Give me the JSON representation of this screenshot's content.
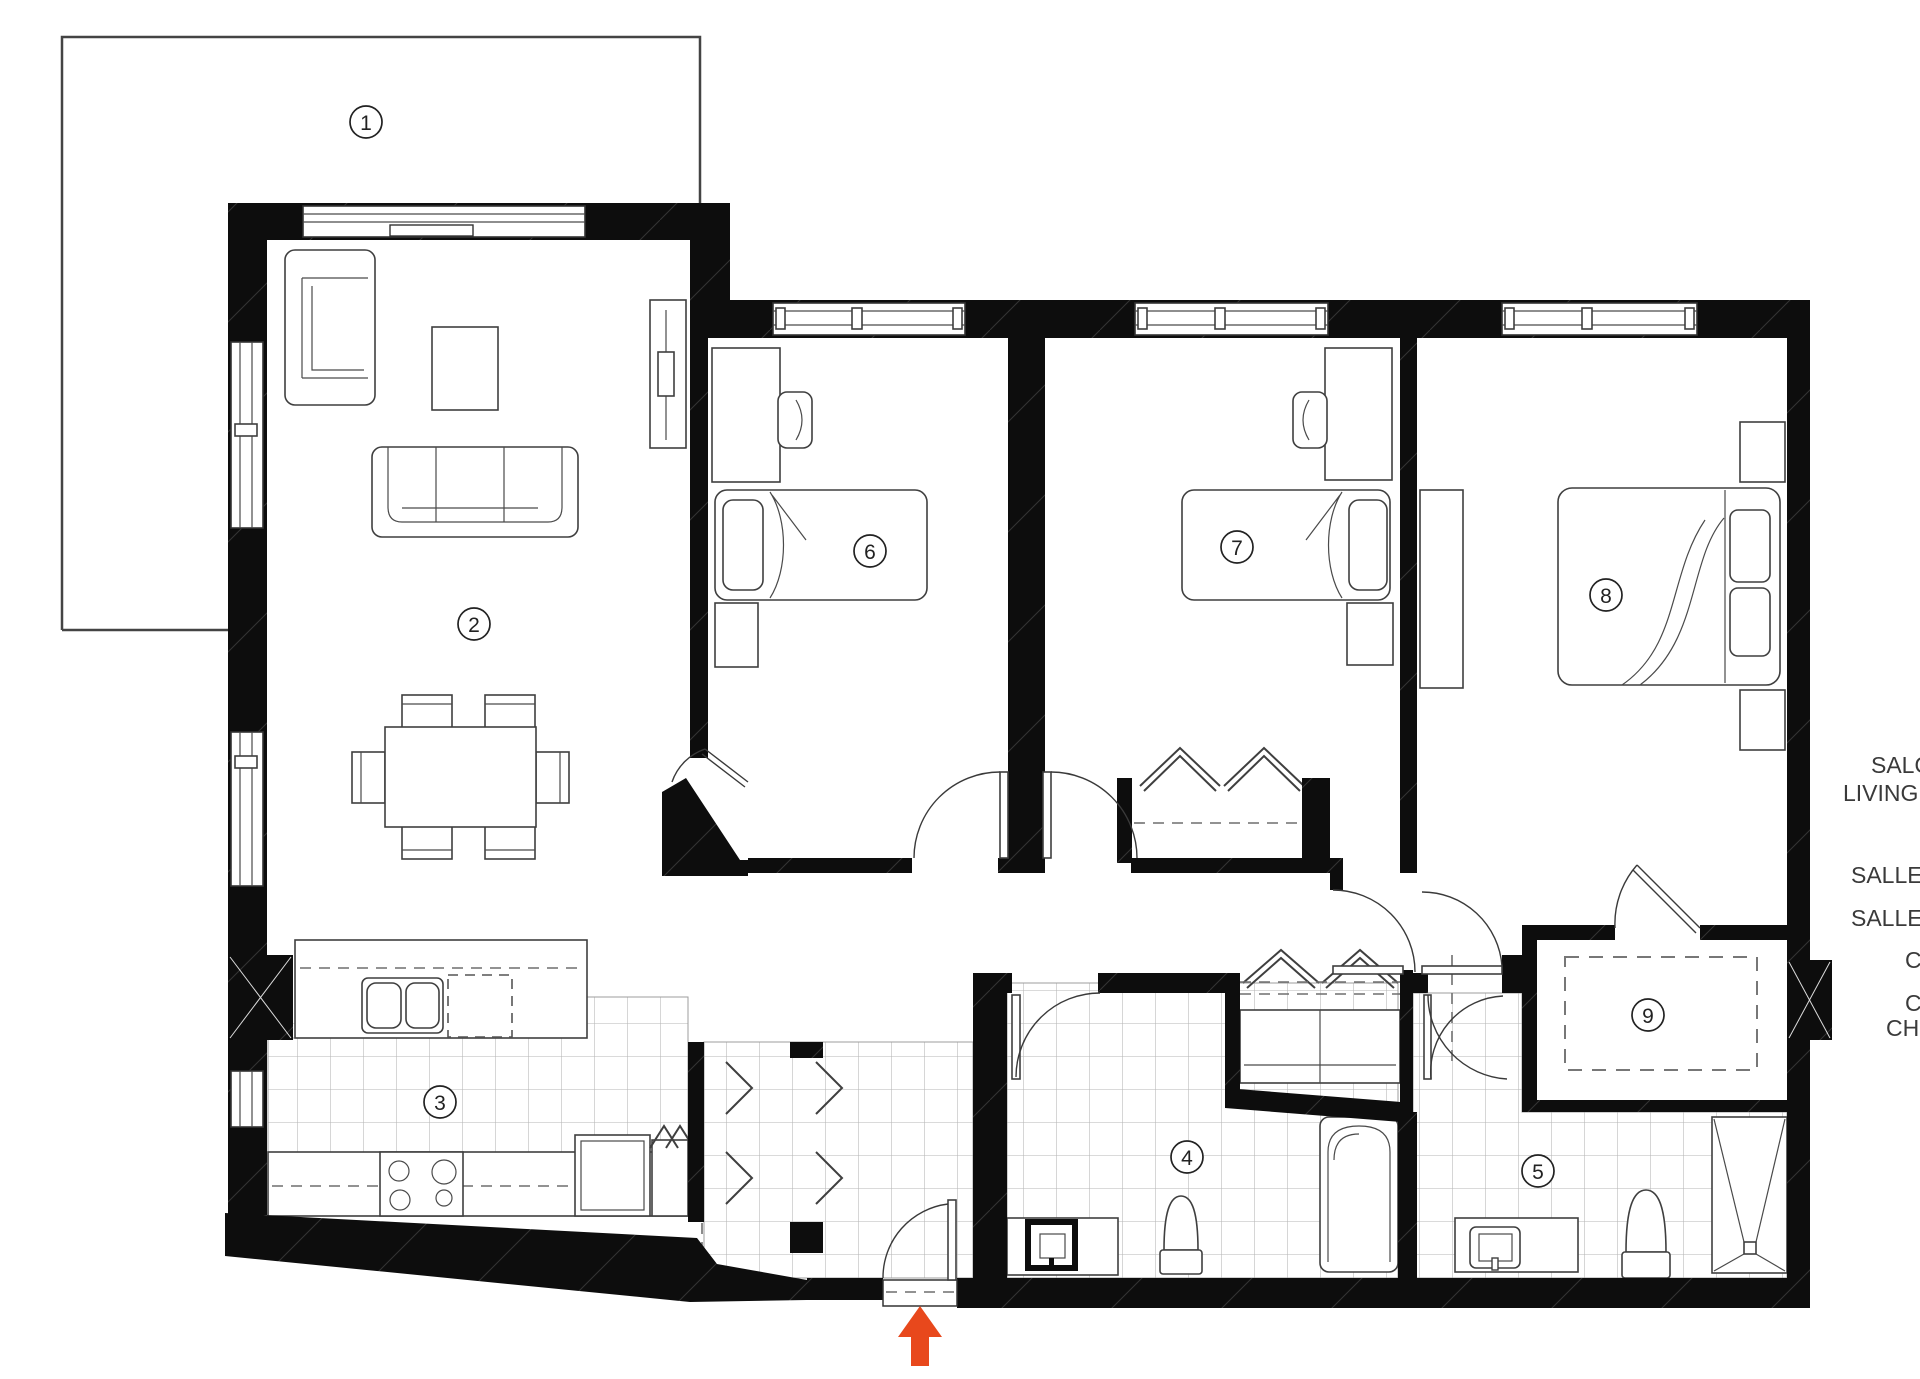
{
  "plan": {
    "rooms": [
      {
        "number": "1"
      },
      {
        "number": "2"
      },
      {
        "number": "3"
      },
      {
        "number": "4"
      },
      {
        "number": "5"
      },
      {
        "number": "6"
      },
      {
        "number": "7"
      },
      {
        "number": "8"
      },
      {
        "number": "9"
      }
    ],
    "legend": {
      "items": [
        "SALO",
        "LIVING R",
        "SALLE",
        "SALLE",
        "C",
        "C",
        "CH"
      ]
    },
    "entrance": {
      "arrow_color": "#e8481c"
    },
    "colors": {
      "wall_ink": "#0d0d0d",
      "tile_line": "#b5b5b5",
      "furniture_line": "#3f3f3f"
    }
  }
}
